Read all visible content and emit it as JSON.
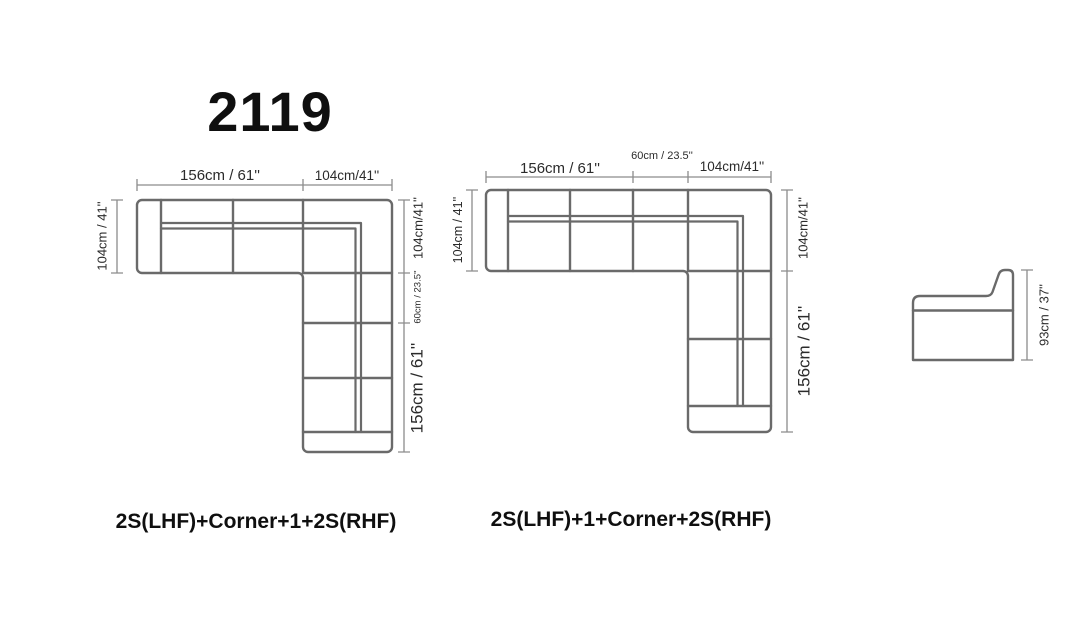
{
  "title": "2119",
  "colors": {
    "sofa_outline": "#6a6a6a",
    "dimension_line": "#8c8c8c",
    "dimension_text": "#2b2b2b",
    "label_text": "#0f0f0f"
  },
  "diagram_left": {
    "label": "2S(LHF)+Corner+1+2S(RHF)",
    "dims": {
      "top_left": "156cm / 61''",
      "top_right": "104cm/41''",
      "left": "104cm / 41''",
      "right_top": "104cm/41''",
      "right_middle": "60cm / 23.5''",
      "right_bottom": "156cm / 61''"
    }
  },
  "diagram_right": {
    "label": "2S(LHF)+1+Corner+2S(RHF)",
    "dims": {
      "top_left": "156cm / 61''",
      "top_middle": "60cm / 23.5''",
      "top_right": "104cm/41''",
      "left": "104cm / 41''",
      "right_top": "104cm/41''",
      "right_bottom": "156cm / 61''"
    }
  },
  "side_view": {
    "dims": {
      "height": "93cm / 37''"
    }
  }
}
